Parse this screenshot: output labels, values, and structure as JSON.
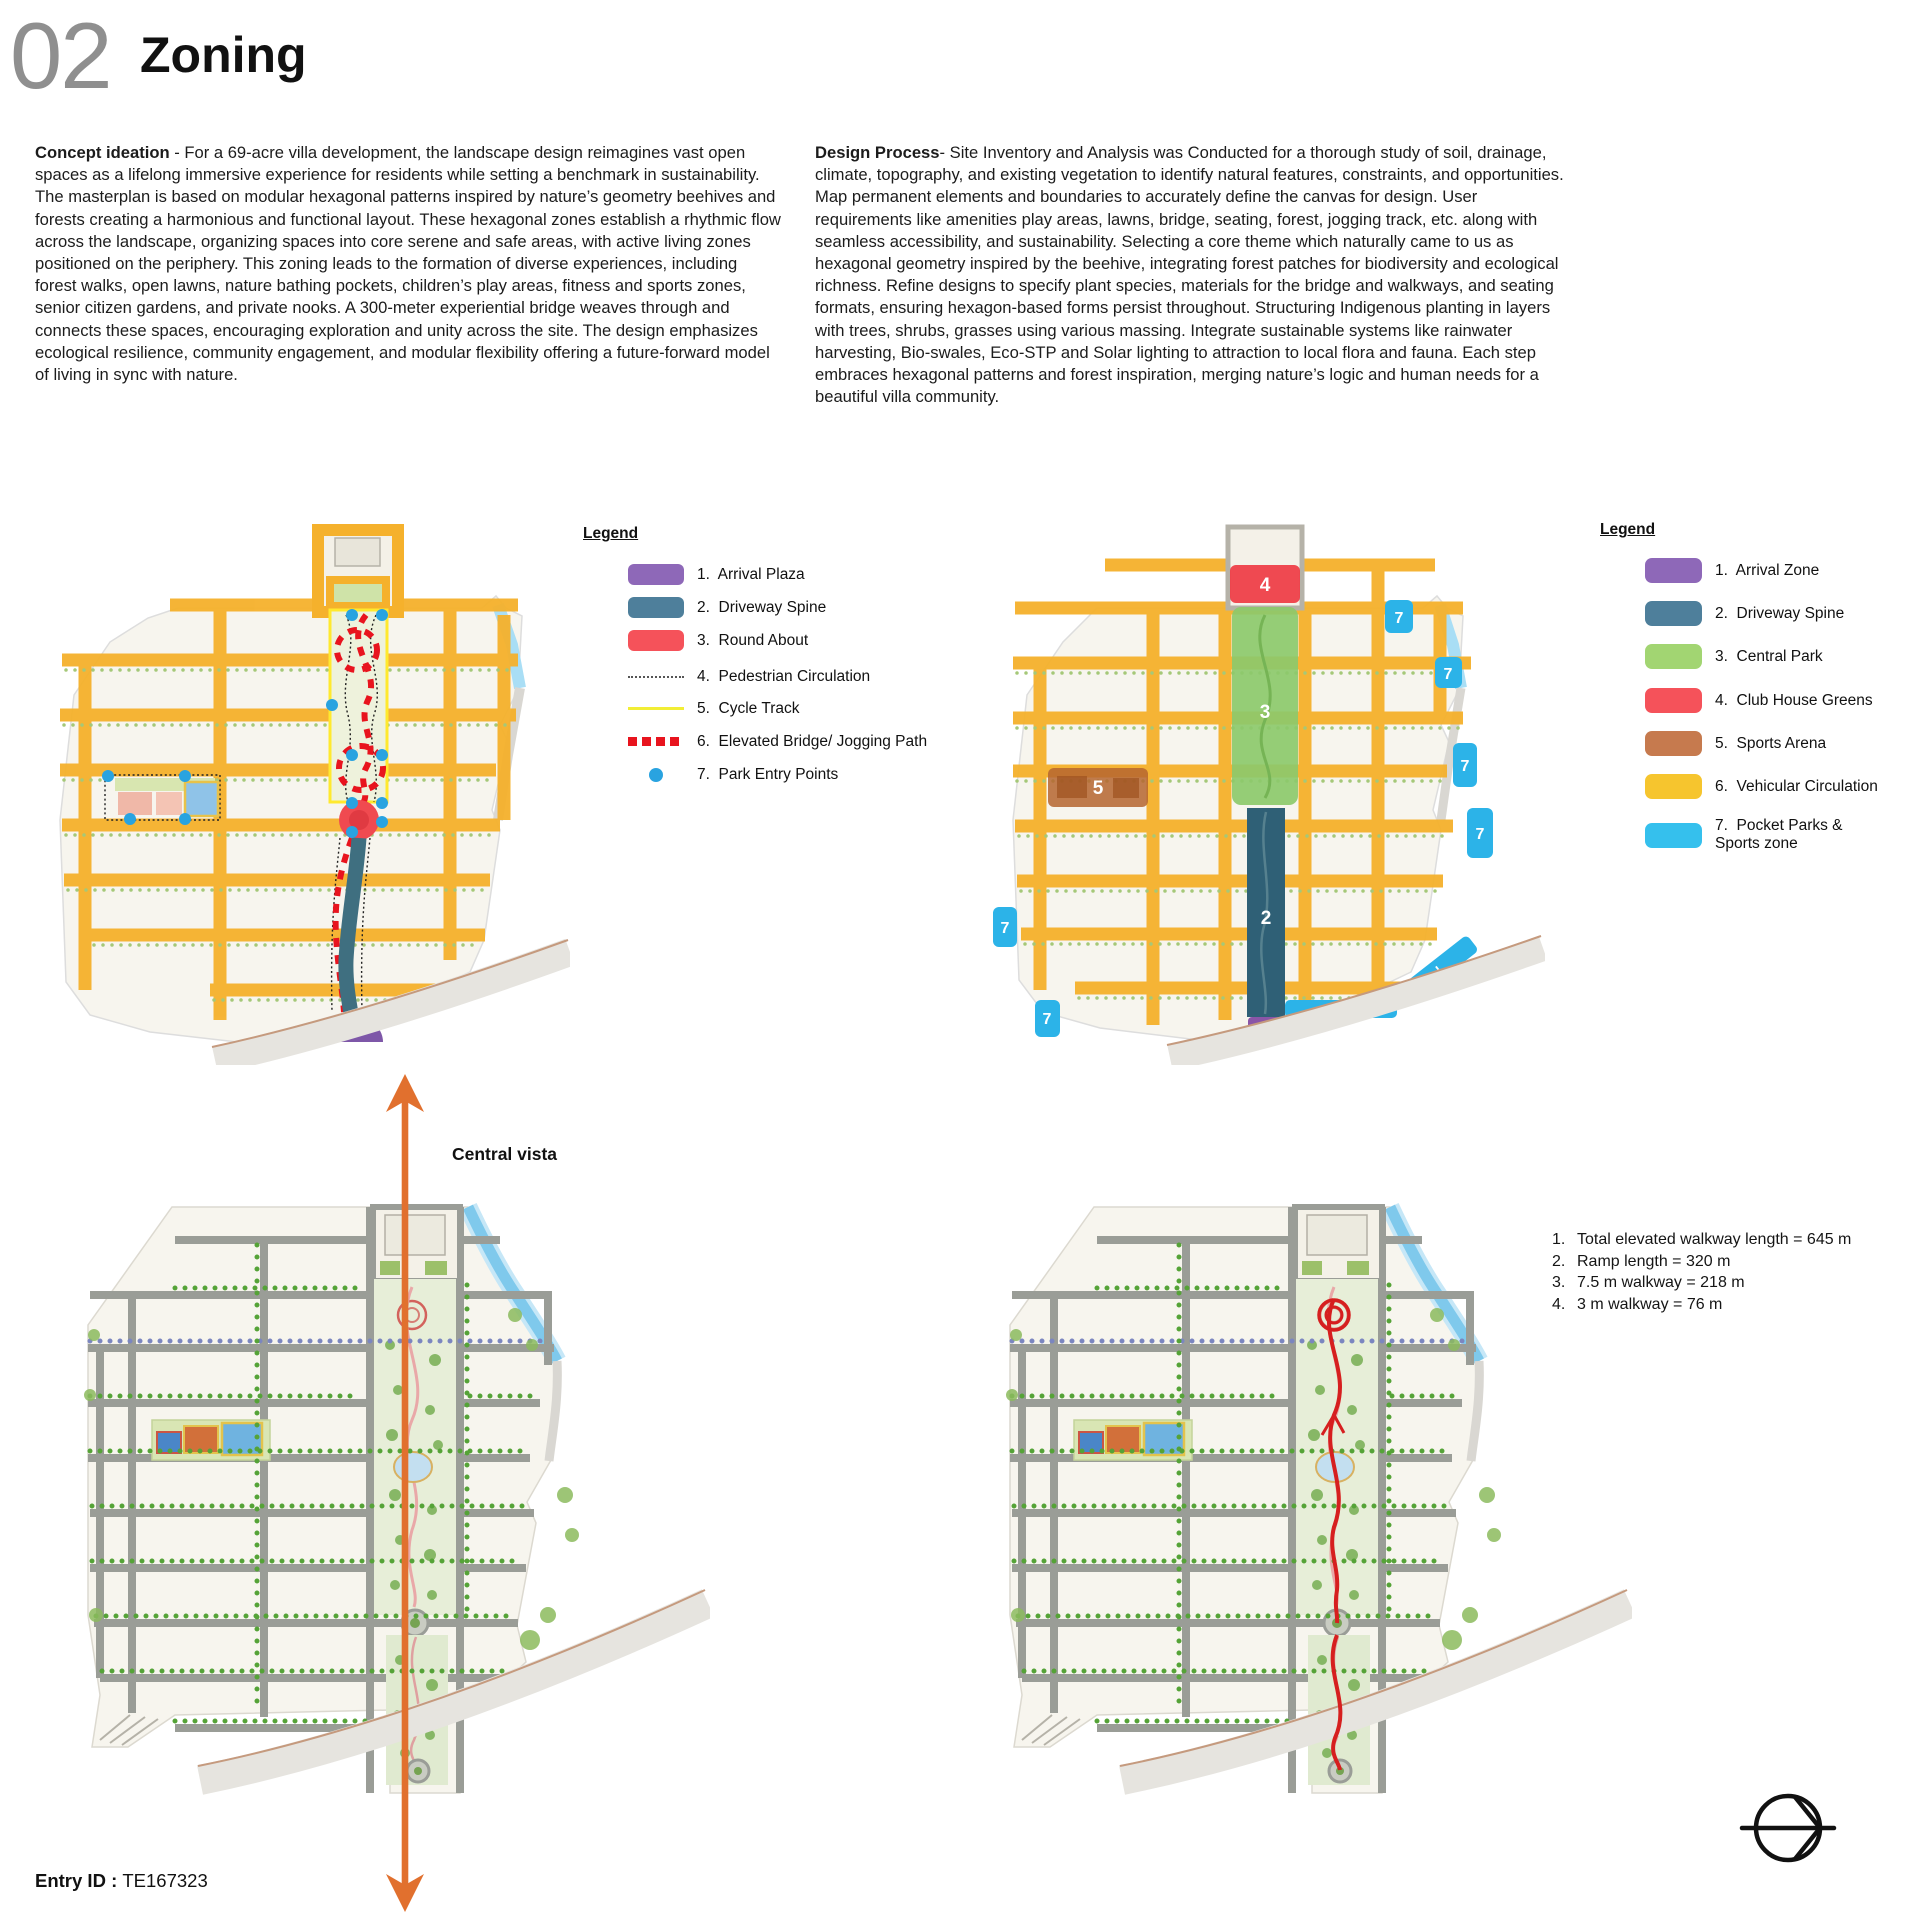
{
  "header": {
    "number": "02",
    "title": "Zoning"
  },
  "concept": {
    "lead": "Concept ideation",
    "body": " - For a 69-acre villa development, the landscape design reimagines vast open spaces as a lifelong immersive experience for residents while setting a benchmark in sustainability. The masterplan is based on modular hexagonal patterns inspired by nature’s geometry beehives and forests creating a harmonious and functional layout. These hexagonal zones establish a rhythmic flow across the landscape, organizing spaces into core serene and safe areas, with active living zones positioned on the periphery. This zoning leads to the formation of diverse experiences, including forest walks, open lawns, nature bathing pockets, children’s play areas, fitness and sports zones, senior citizen gardens, and private nooks. A 300-meter experiential bridge weaves through and connects these spaces, encouraging exploration and unity across the site. The design emphasizes ecological resilience, community engagement, and modular flexibility offering a future-forward model of living in sync with nature."
  },
  "process": {
    "lead": "Design Process",
    "body": "- Site Inventory and Analysis was Conducted for a thorough study of soil, drainage, climate, topography, and existing vegetation to identify natural features, constraints, and opportunities. Map permanent elements and boundaries to accurately define the canvas for design. User requirements like amenities play areas, lawns, bridge, seating, forest, jogging track, etc. along with seamless accessibility, and sustainability. Selecting a core theme which naturally came to us as hexagonal geometry inspired by the beehive, integrating forest patches for biodiversity and ecological richness. Refine designs to specify plant species, materials for the bridge and walkways, and seating formats, ensuring hexagon-based forms persist throughout. Structuring Indigenous planting in layers with trees, shrubs, grasses using various massing. Integrate sustainable systems like rainwater harvesting, Bio-swales, Eco-STP and Solar lighting to attraction to local flora and fauna. Each step embraces hexagonal patterns and forest inspiration, merging nature’s logic and human needs for a beautiful villa community."
  },
  "legend_left": {
    "title": "Legend",
    "items": [
      {
        "label": "1.  Arrival Plaza",
        "color": "#8e68b8",
        "swatch": "rect"
      },
      {
        "label": "2.  Driveway Spine",
        "color": "#4e7f9b",
        "swatch": "rect"
      },
      {
        "label": "3.  Round About",
        "color": "#f5525a",
        "swatch": "rect"
      },
      {
        "label": "4.  Pedestrian Circulation",
        "color": "#555555",
        "swatch": "dotted-line"
      },
      {
        "label": "5.  Cycle Track",
        "color": "#f2ee35",
        "swatch": "solid-line"
      },
      {
        "label": "6.  Elevated Bridge/ Jogging Path",
        "color": "#e8141e",
        "swatch": "dashed-squares"
      },
      {
        "label": "7.  Park Entry Points",
        "color": "#29a3e0",
        "swatch": "dot"
      }
    ]
  },
  "legend_right": {
    "title": "Legend",
    "items": [
      {
        "label": "1.  Arrival Zone",
        "color": "#8e68b8",
        "swatch": "rect"
      },
      {
        "label": "2.  Driveway Spine",
        "color": "#4e7f9b",
        "swatch": "rect"
      },
      {
        "label": "3.  Central Park",
        "color": "#a2d572",
        "swatch": "rect"
      },
      {
        "label": "4.  Club House Greens",
        "color": "#f5525a",
        "swatch": "rect"
      },
      {
        "label": "5.  Sports Arena",
        "color": "#c67a4e",
        "swatch": "rect"
      },
      {
        "label": "6.  Vehicular Circulation",
        "color": "#f6c52e",
        "swatch": "rect"
      },
      {
        "label": "7.  Pocket Parks & Sports zone",
        "color": "#35c0ed",
        "swatch": "rect"
      }
    ]
  },
  "map_right_zones": {
    "arrival": "1",
    "driveway": "2",
    "central_park": "3",
    "club_house": "4",
    "sports_arena": "5",
    "pocket": "7"
  },
  "central_vista_label": "Central vista",
  "walkway_notes": {
    "items": [
      {
        "num": "1.",
        "text": "Total elevated walkway length = 645 m"
      },
      {
        "num": "2.",
        "text": "Ramp length = 320 m"
      },
      {
        "num": "3.",
        "text": "7.5 m walkway = 218 m"
      },
      {
        "num": "4.",
        "text": "3 m walkway = 76 m"
      }
    ]
  },
  "footer": {
    "entry_label": "Entry ID : ",
    "entry_value": "TE167323"
  },
  "colors": {
    "title_gray": "#8f8f8f",
    "accent_orange": "#e1702e",
    "road_yellow": "#f5b12c",
    "arrival_purple": "#8e68b8",
    "driveway_teal": "#3f6f80",
    "roundabout_red": "#f04a50",
    "central_park_green": "#8cc96b",
    "club_red": "#ee3b43",
    "sports_brown": "#c0703f",
    "pocket_cyan": "#2cb3e8",
    "entry_point_blue": "#29a3e0",
    "bridge_red": "#e8141e",
    "cycle_yellow": "#f2ee35"
  }
}
